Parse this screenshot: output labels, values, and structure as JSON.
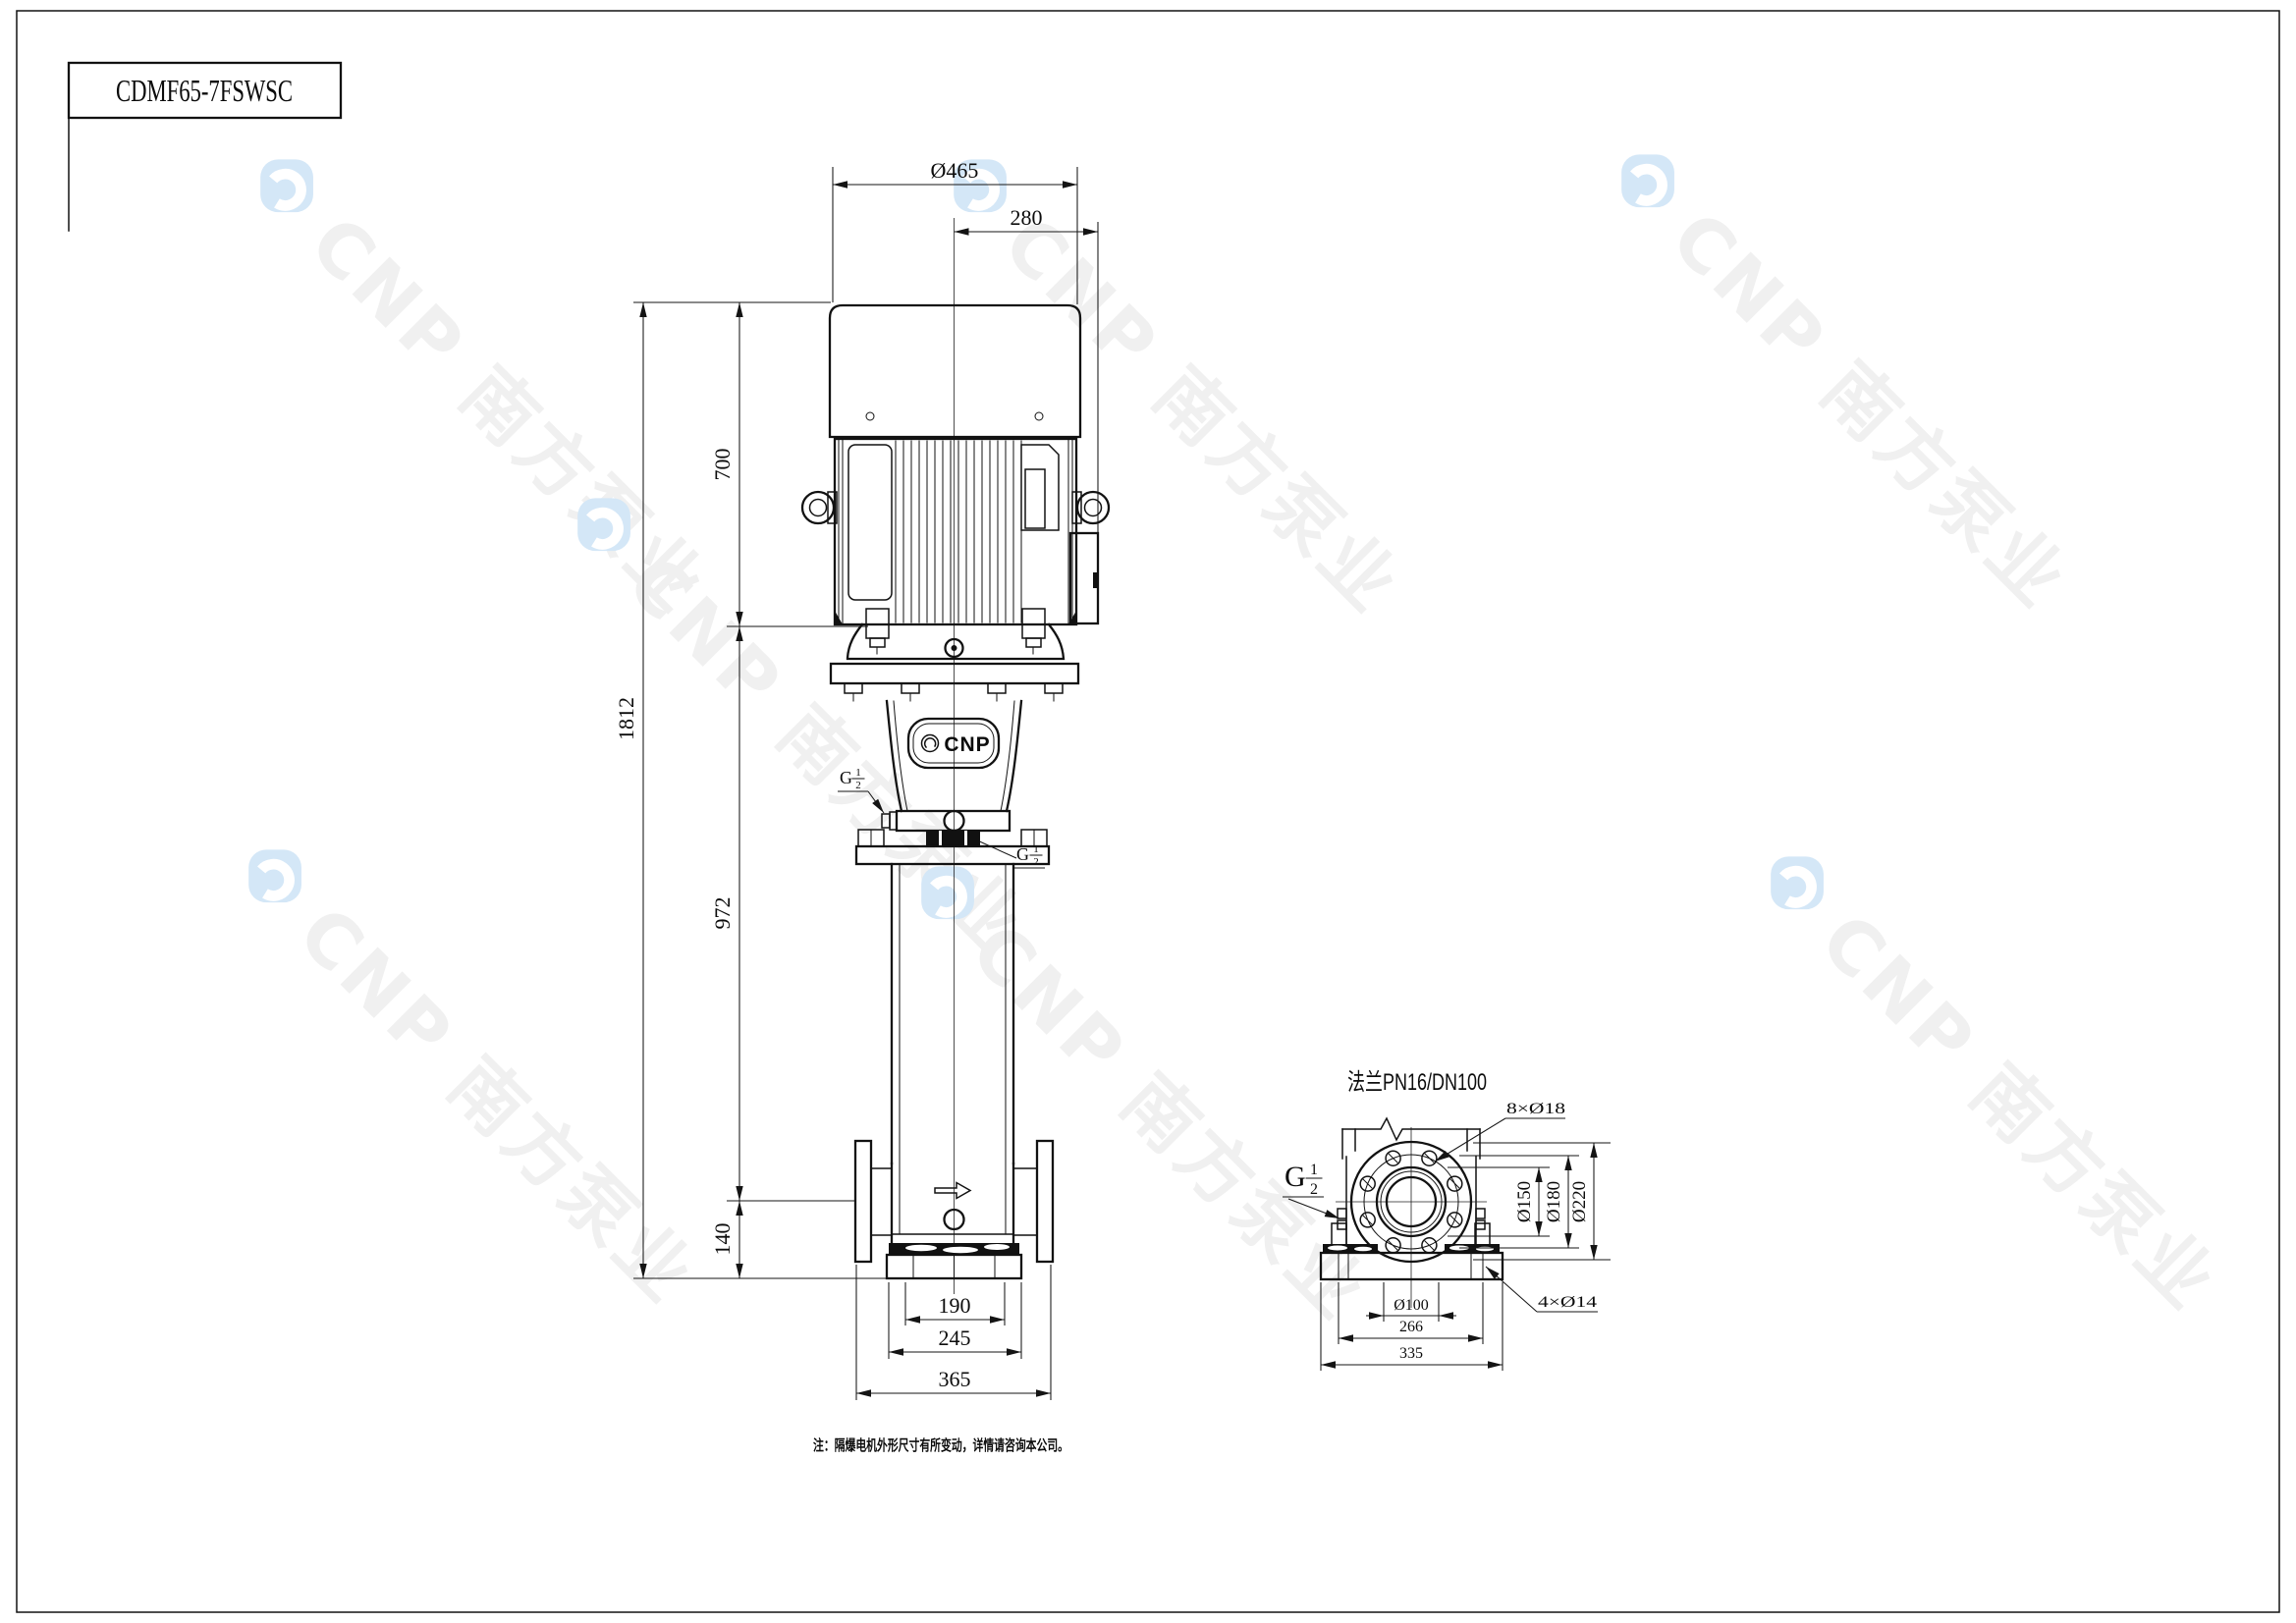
{
  "page": {
    "title": "CDMF65-7FSWSC",
    "note": "注：隔爆电机外形尺寸有所变动，详情请咨询本公司。"
  },
  "watermark": {
    "brand": "CNP 南方泵业",
    "logo_color": "#d4e7f7",
    "text_color": "#f0f0f0"
  },
  "front_view": {
    "brand_plate": "CNP",
    "dims": {
      "fan_cover_dia": "Ø465",
      "center_to_box": "280",
      "motor_height": "700",
      "total_height": "1812",
      "pump_body_height": "972",
      "port_center_height": "140",
      "base_inner": "190",
      "base_mid": "245",
      "base_outer": "365"
    },
    "port_thread": {
      "prefix": "G",
      "num": "1",
      "den": "2"
    }
  },
  "side_view": {
    "flange_title": "法兰PN16/DN100",
    "bolt_holes_label": "8×Ø18",
    "anchor_holes_label": "4×Ø14",
    "port_thread": {
      "prefix": "G",
      "num": "1",
      "den": "2"
    },
    "dims": {
      "raised_face_dia": "Ø150",
      "bolt_circle_dia": "Ø180",
      "flange_od": "Ø220",
      "port_dia": "Ø100",
      "bolt_spacing": "266",
      "base_width": "335"
    }
  }
}
